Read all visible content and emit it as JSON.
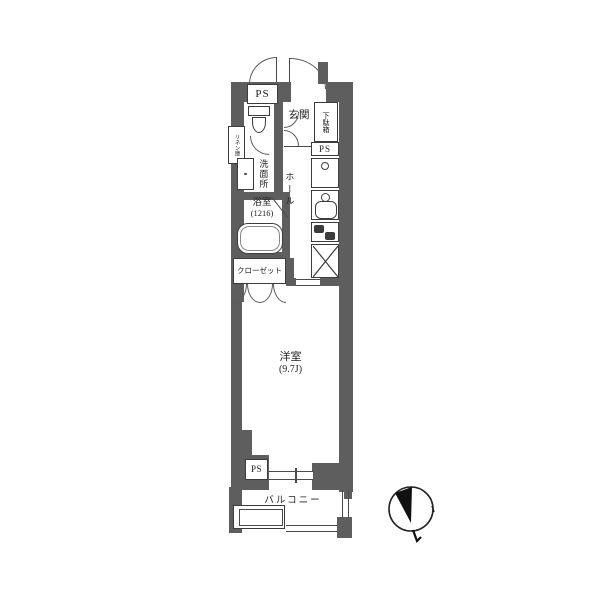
{
  "plan": {
    "title": "apartment-floor-plan",
    "labels": {
      "ps_top": "PS",
      "entrance": "玄関",
      "shoe_cabinet": "下駄箱",
      "ps_kitchen": "PS",
      "linen_closet": "リネン庫",
      "washroom": "洗面所",
      "hall": "ホール",
      "bathroom": "浴室",
      "bathroom_size": "(1216)",
      "closet": "クローゼット",
      "western_room": "洋室",
      "western_room_size": "(9.7J)",
      "ps_bottom": "PS",
      "balcony": "バルコニー"
    },
    "colors": {
      "wall": "#5e5e5e",
      "outline": "#3c3c3c",
      "background": "#ffffff",
      "compass": "#111111"
    },
    "icons": [
      "door-arc-icon",
      "toilet-icon",
      "washbasin-icon",
      "bathtub-icon",
      "washing-machine-icon",
      "kitchen-sink-icon",
      "stove-icon",
      "refrigerator-x-icon",
      "sliding-window-icon",
      "hatch-icon",
      "compass-north-icon"
    ]
  }
}
